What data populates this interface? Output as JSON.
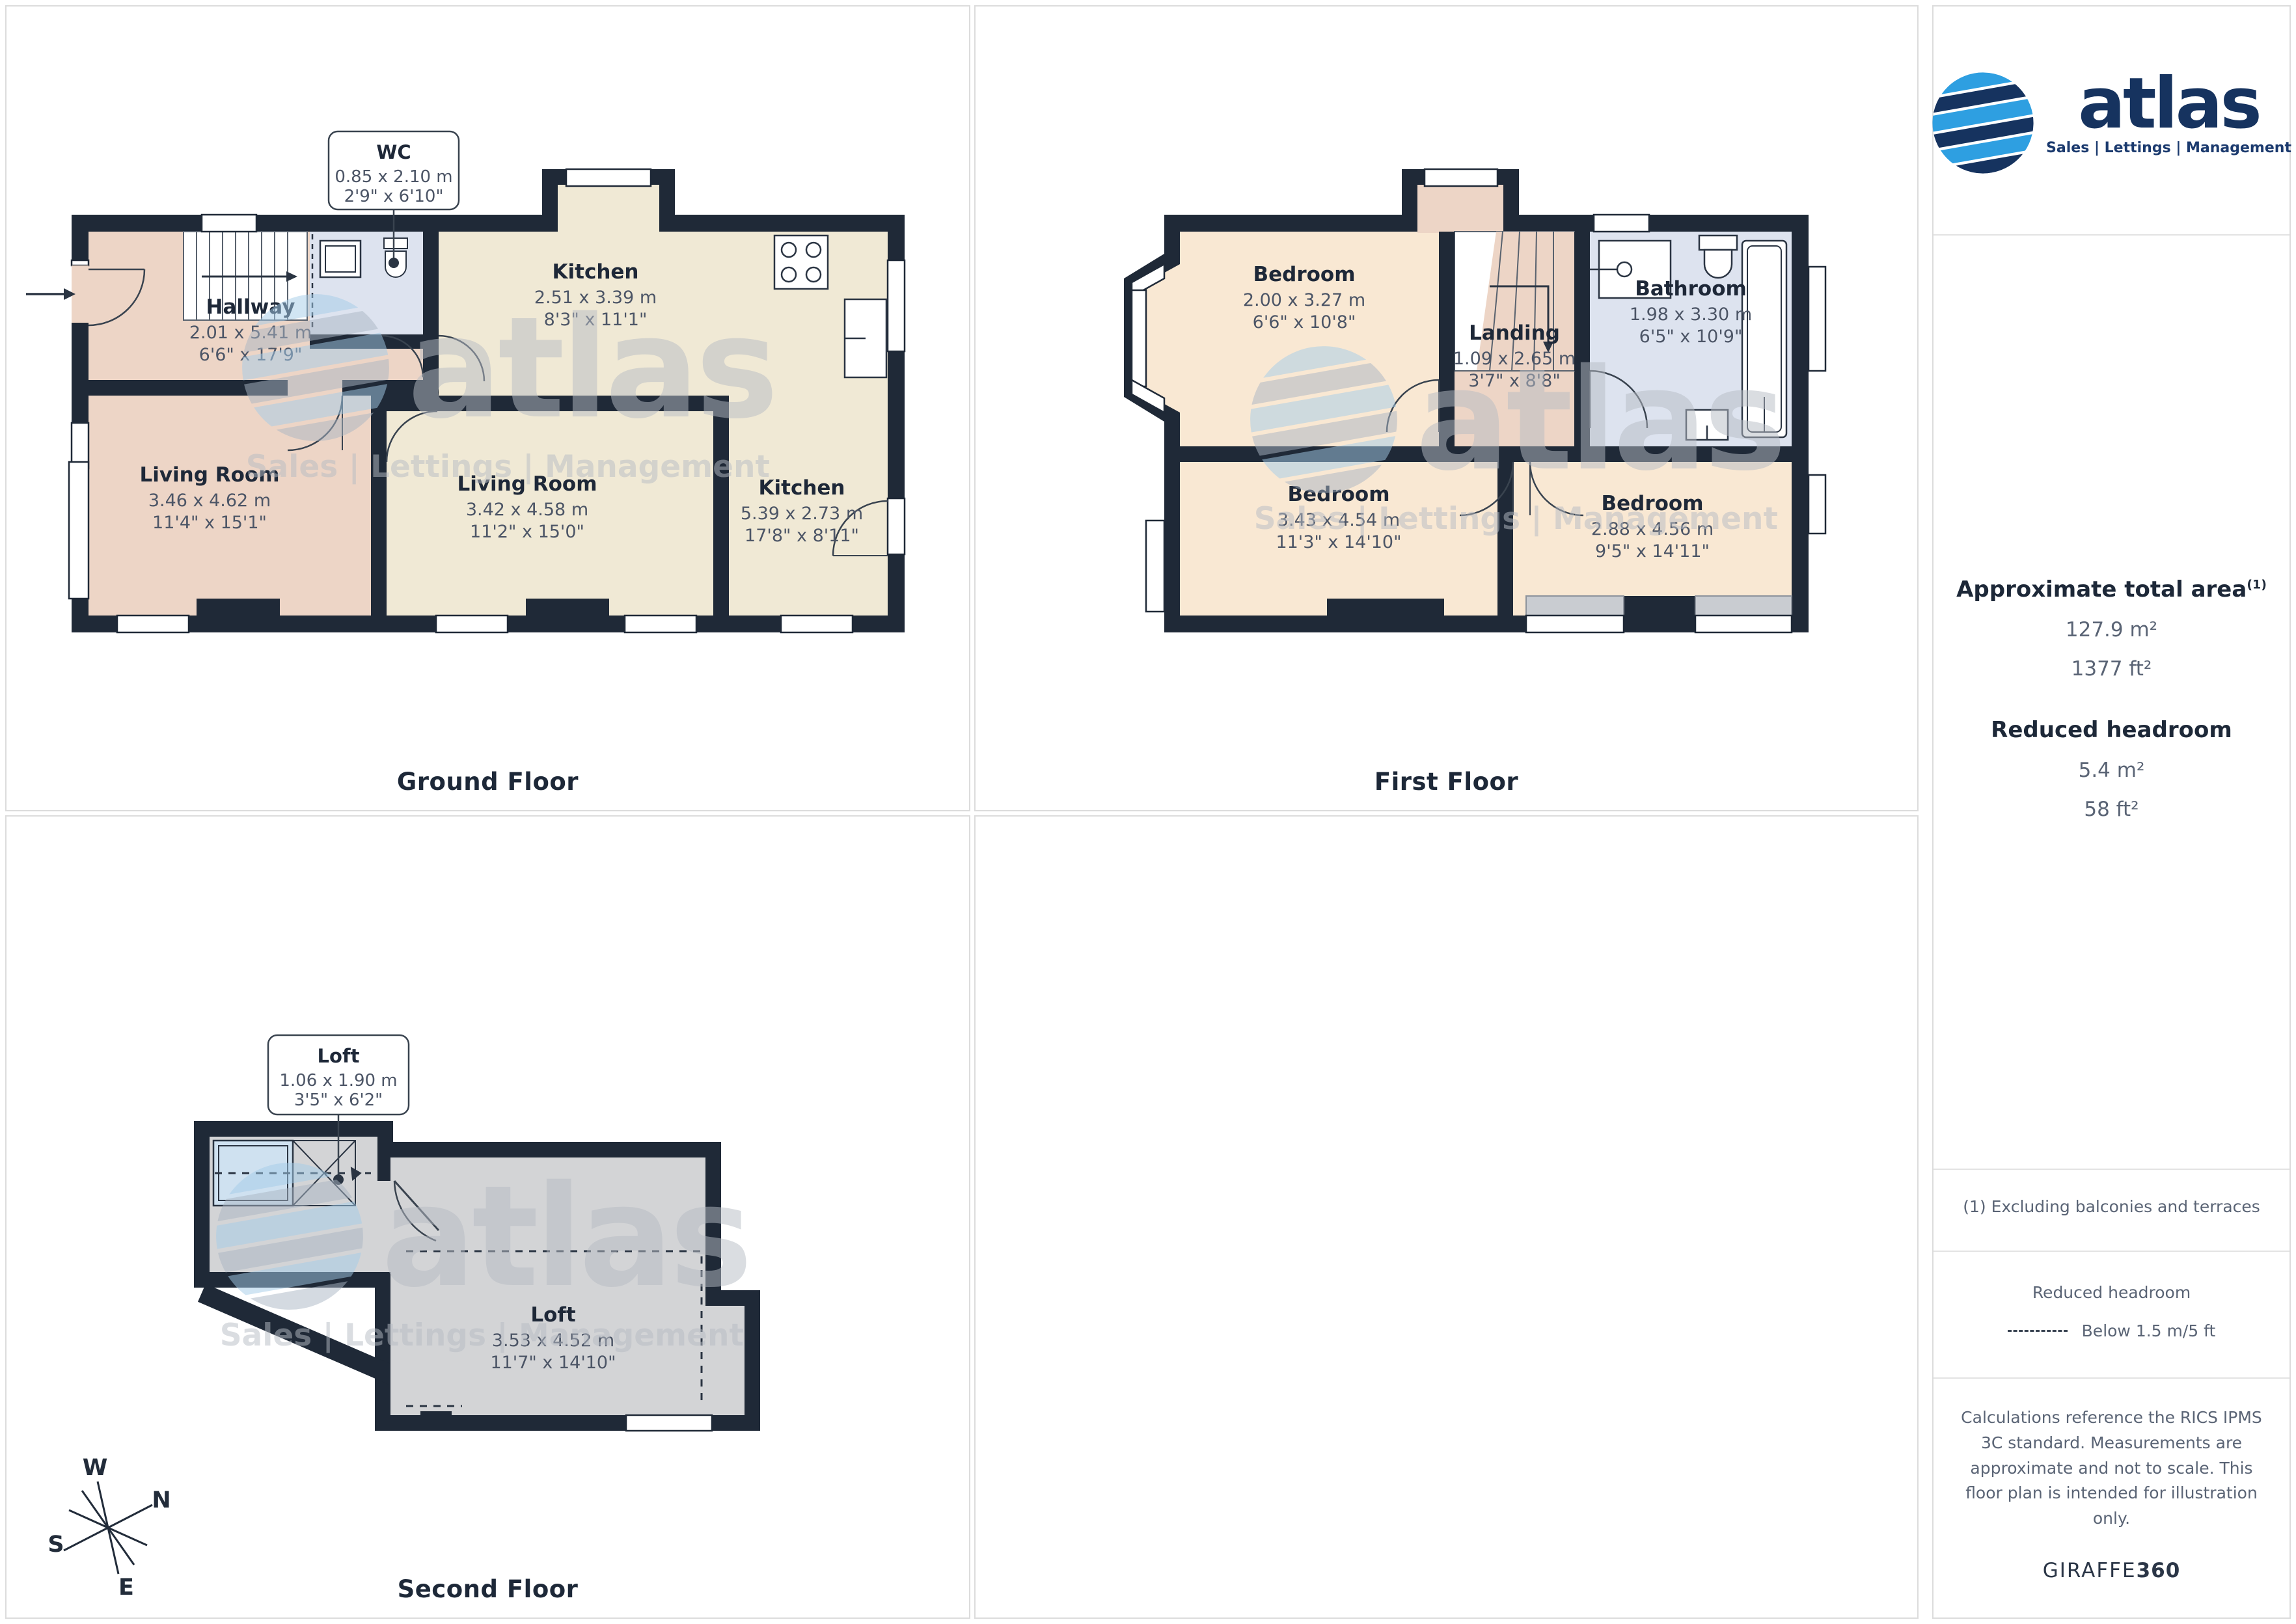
{
  "branding": {
    "logo_text": "atlas",
    "logo_tagline": "Sales | Lettings | Management",
    "watermark_text": "atlas",
    "watermark_tagline": "Sales | Lettings | Management",
    "credit_prefix": "GIRAFFE",
    "credit_suffix": "360"
  },
  "colors": {
    "wall": "#1f2937",
    "room_pink": "#edd5c6",
    "room_cream": "#f0e9d5",
    "room_blue": "#dde3ef",
    "room_gray": "#d3d4d6",
    "terrace_gray": "#c9ccd1",
    "brand_light_blue": "#2e9fe1",
    "brand_navy": "#16335f"
  },
  "sidebar": {
    "total_area": {
      "heading": "Approximate total area",
      "footnote_marker": "(1)",
      "metric": "127.9 m²",
      "imperial": "1377 ft²"
    },
    "reduced_headroom": {
      "heading": "Reduced headroom",
      "metric": "5.4 m²",
      "imperial": "58 ft²"
    },
    "footnote": "(1) Excluding balconies and terraces",
    "legend": {
      "heading": "Reduced headroom",
      "item": "Below 1.5 m/5 ft"
    },
    "disclaimer": "Calculations reference the RICS IPMS 3C standard. Measurements are approximate and not to scale. This floor plan is intended for illustration only."
  },
  "compass": {
    "n": "N",
    "s": "S",
    "e": "E",
    "w": "W"
  },
  "floors": {
    "ground": {
      "label": "Ground Floor",
      "rooms": {
        "hallway": {
          "name": "Hallway",
          "metric": "2.01 x 5.41 m",
          "imperial": "6'6\" x 17'9\""
        },
        "wc": {
          "name": "WC",
          "metric": "0.85 x 2.10 m",
          "imperial": "2'9\" x 6'10\""
        },
        "kitchen_top": {
          "name": "Kitchen",
          "metric": "2.51 x 3.39 m",
          "imperial": "8'3\" x 11'1\""
        },
        "living_left": {
          "name": "Living Room",
          "metric": "3.46 x 4.62 m",
          "imperial": "11'4\" x 15'1\""
        },
        "living_mid": {
          "name": "Living Room",
          "metric": "3.42 x 4.58 m",
          "imperial": "11'2\" x 15'0\""
        },
        "kitchen_right": {
          "name": "Kitchen",
          "metric": "5.39 x 2.73 m",
          "imperial": "17'8\" x 8'11\""
        }
      }
    },
    "first": {
      "label": "First Floor",
      "rooms": {
        "bedroom_small": {
          "name": "Bedroom",
          "metric": "2.00 x 3.27 m",
          "imperial": "6'6\" x 10'8\""
        },
        "landing": {
          "name": "Landing",
          "metric": "1.09 x 2.65 m",
          "imperial": "3'7\" x 8'8\""
        },
        "bathroom": {
          "name": "Bathroom",
          "metric": "1.98 x 3.30 m",
          "imperial": "6'5\" x 10'9\""
        },
        "bedroom_left": {
          "name": "Bedroom",
          "metric": "3.43 x 4.54 m",
          "imperial": "11'3\" x 14'10\""
        },
        "bedroom_right": {
          "name": "Bedroom",
          "metric": "2.88 x 4.56 m",
          "imperial": "9'5\" x 14'11\""
        }
      }
    },
    "second": {
      "label": "Second Floor",
      "rooms": {
        "loft_hatch": {
          "name": "Loft",
          "metric": "1.06 x 1.90 m",
          "imperial": "3'5\" x 6'2\""
        },
        "loft": {
          "name": "Loft",
          "metric": "3.53 x 4.52 m",
          "imperial": "11'7\" x 14'10\""
        }
      }
    }
  }
}
